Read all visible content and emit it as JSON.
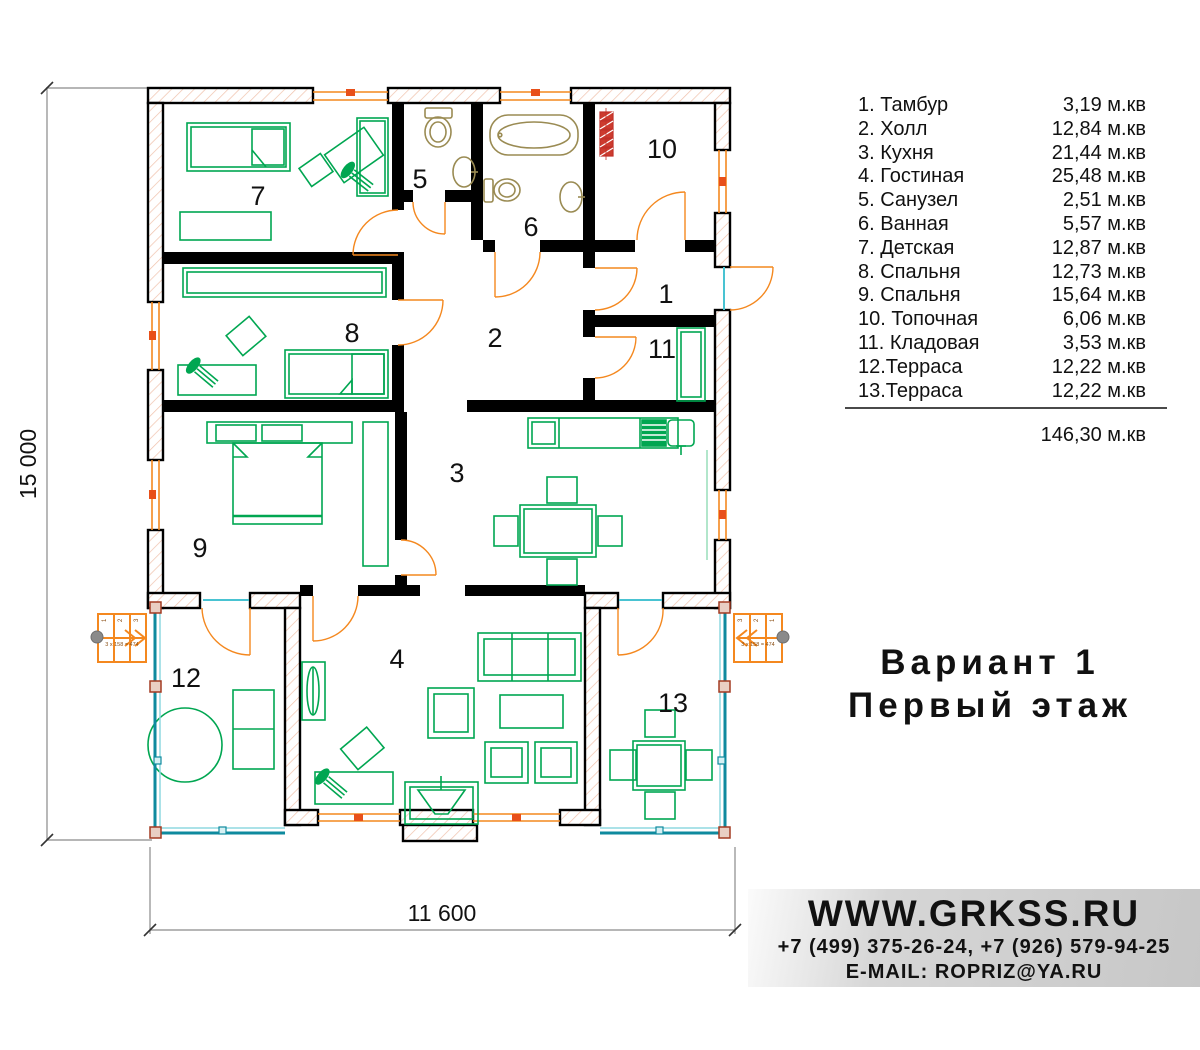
{
  "legend": {
    "rows": [
      {
        "name": "1. Тамбур",
        "area": "3,19 м.кв"
      },
      {
        "name": "2. Холл",
        "area": "12,84 м.кв"
      },
      {
        "name": "3. Кухня",
        "area": "21,44 м.кв"
      },
      {
        "name": "4. Гостиная",
        "area": "25,48 м.кв"
      },
      {
        "name": "5. Санузел",
        "area": "2,51 м.кв"
      },
      {
        "name": "6. Ванная",
        "area": "5,57 м.кв"
      },
      {
        "name": "7. Детская",
        "area": "12,87 м.кв"
      },
      {
        "name": "8. Спальня",
        "area": "12,73 м.кв"
      },
      {
        "name": "9. Спальня",
        "area": "15,64 м.кв"
      },
      {
        "name": "10. Топочная",
        "area": "6,06 м.кв"
      },
      {
        "name": "11. Кладовая",
        "area": "3,53 м.кв"
      },
      {
        "name": "12.Терраса",
        "area": "12,22 м.кв"
      },
      {
        "name": "13.Терраса",
        "area": "12,22 м.кв"
      }
    ],
    "total": "146,30 м.кв"
  },
  "plan": {
    "dim_left": "15 000",
    "dim_bottom": "11 600",
    "stair_note": "3 x 158 = 474",
    "stair_steps": [
      "1",
      "2",
      "3"
    ],
    "room_numbers": [
      "1",
      "2",
      "3",
      "4",
      "5",
      "6",
      "7",
      "8",
      "9",
      "10",
      "11",
      "12",
      "13"
    ]
  },
  "title": {
    "line1": "Вариант 1",
    "line2": "Первый этаж"
  },
  "contact": {
    "website": "WWW.GRKSS.RU",
    "phones": "+7 (499) 375-26-24, +7 (926) 579-94-25",
    "email": "E-MAIL: ROPRIZ@YA.RU"
  },
  "colors": {
    "wall": "#000000",
    "furniture_green": "#00a651",
    "doors_windows_orange": "#f4881f",
    "terrace_rail_teal": "#0e8a9e",
    "bath_fixture_tan": "#9a8b53",
    "boiler_red": "#c03028",
    "wall_hatch_pink": "#f0c2ac"
  }
}
